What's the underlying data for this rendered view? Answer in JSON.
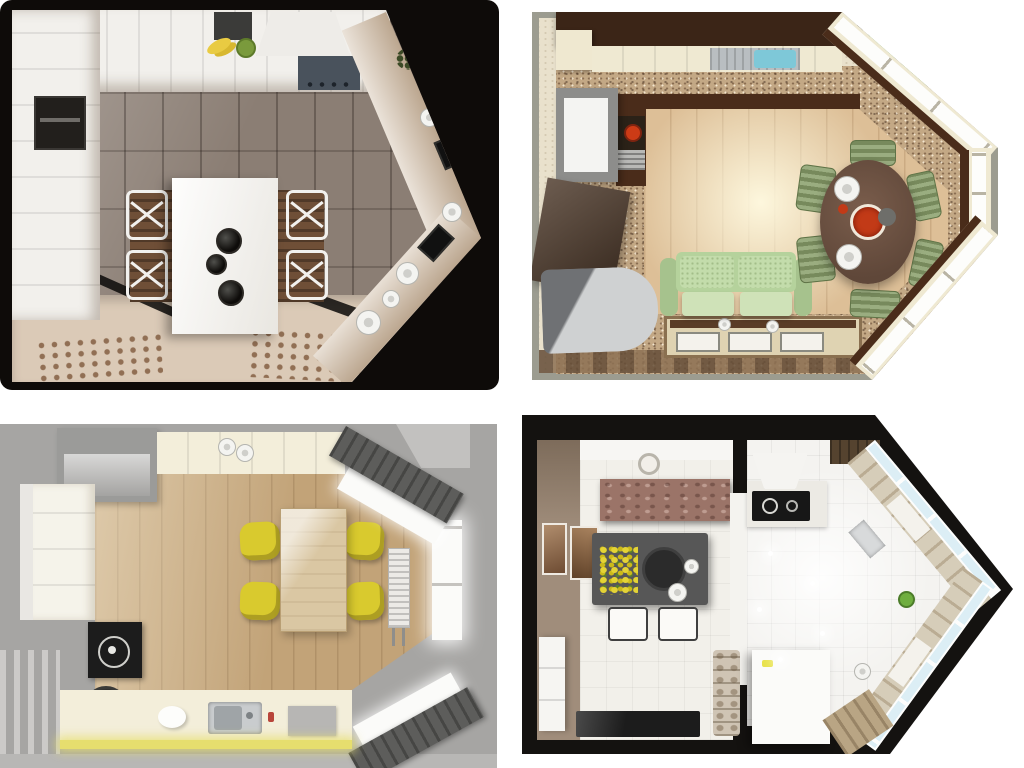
{
  "page": {
    "title": "Collage of four top-view 3D renderings of kitchen and living-room layouts",
    "background": "#ffffff"
  },
  "panels": {
    "top_left": {
      "name": "white-classic-kitchen-on-black",
      "description": "Top view of a white classic kitchen with central white dining table, cross-back chairs and beige carpet, on a black background shaped like an arrow pointing right",
      "background": "#0e0b09",
      "floor": "#8b7e74",
      "carpet": "#dbcab7",
      "cabinets": "#f2f0ec",
      "hood": "#eeece8",
      "cooktop": "#49525c",
      "table": "#f8f7f4",
      "bench": "#6f4f37",
      "counter": "#d2c0ab",
      "candle": "#16110d",
      "banana": "#e9cb42",
      "oven": "#221f1c",
      "ornament": "#7b5437"
    },
    "top_right": {
      "name": "kitchen-living-room-green-sofa",
      "description": "Top view of a kitchen-living room with dark brown cabinets, speckled tile, light wood floor, green sofa, gray ottoman, round brown dining table with red dishes and a window bay",
      "background": "#ffffff",
      "outer_wall": "#9c9c90",
      "wall": "#e9e1cc",
      "upper_cabinets": "#3b2517",
      "counter": "#efe9d2",
      "sink_steel": "#b9bec1",
      "sink_basin": "#7ec8d8",
      "tile": "#c3a885",
      "wood_floor": "#ddbf97",
      "counter_dark": "#4a2c1a",
      "fridge": "#8d8d8b",
      "burner": "#cc3b16",
      "door_panel": "#4c3829",
      "ottoman": "#c7c9ca",
      "sofa": "#b5d29c",
      "rug": "#dfd3b2",
      "table_round": "#6d5344",
      "chair_green": "#8aa06b",
      "stool_green": "#7cb35a",
      "red_dish": "#c23a17",
      "window_frame": "#efe9d2",
      "glass": "#fdfdfb"
    },
    "bottom_left": {
      "name": "kitchen-yellow-chairs-gray-backdrop",
      "description": "Top view of a kitchen with light oak floor, wooden table with four yellow chairs, cream counters, washing machine, sink and a bay window with dark gray cornices on a gray backdrop",
      "background": "#a6a5a3",
      "floor_strip": "#b8b7b5",
      "wood_floor": "#c2a378",
      "counter": "#f3eeda",
      "cabinet_white": "#f5f3ea",
      "fridge": "#9b9b99",
      "fridge_front": "#b2b1af",
      "table": "#dac7a3",
      "chair_yellow": "#d9ca2e",
      "cornice": "#5d5d5b",
      "window": "#fbfbf9",
      "radiator": "#eceae6",
      "cooktop": "#1c1c1c",
      "washer_door": "#161616",
      "sink": "#c9ccce",
      "appliance": "#b7b6b4",
      "light_strip": "#e6de6e"
    },
    "bottom_right": {
      "name": "studio-arrow-plan-white-kitchen",
      "description": "Top view of an arrow-shaped studio: taupe dining room with dark gray table and yellow flowers on the left, white glossy kitchen with corner counters, cooktop and window bay on the right, outlined in black",
      "background": "#ffffff",
      "outline": "#141210",
      "wall_taupe": "#a08d7b",
      "floor_left": "#f2f0ea",
      "floor_kitchen": "#f4f3f0",
      "cabinet_brown": "#9b7468",
      "table_gray": "#575757",
      "flowers": "#e4d335",
      "platter": "#2b2b2b",
      "sideboard": "#f6f5f2",
      "tv": "#1c1c1c",
      "picture_brown": "#8a6a52",
      "counter_wood": "#d6cdb9",
      "counter_wood_dark": "#b9a584",
      "glass_blue": "#dceef5",
      "hood": "#f5f4f1",
      "cooktop": "#171717",
      "stone_pillar": "#cfc4b4",
      "plant": "#6fae3f",
      "island": "#fbfbf9"
    }
  }
}
